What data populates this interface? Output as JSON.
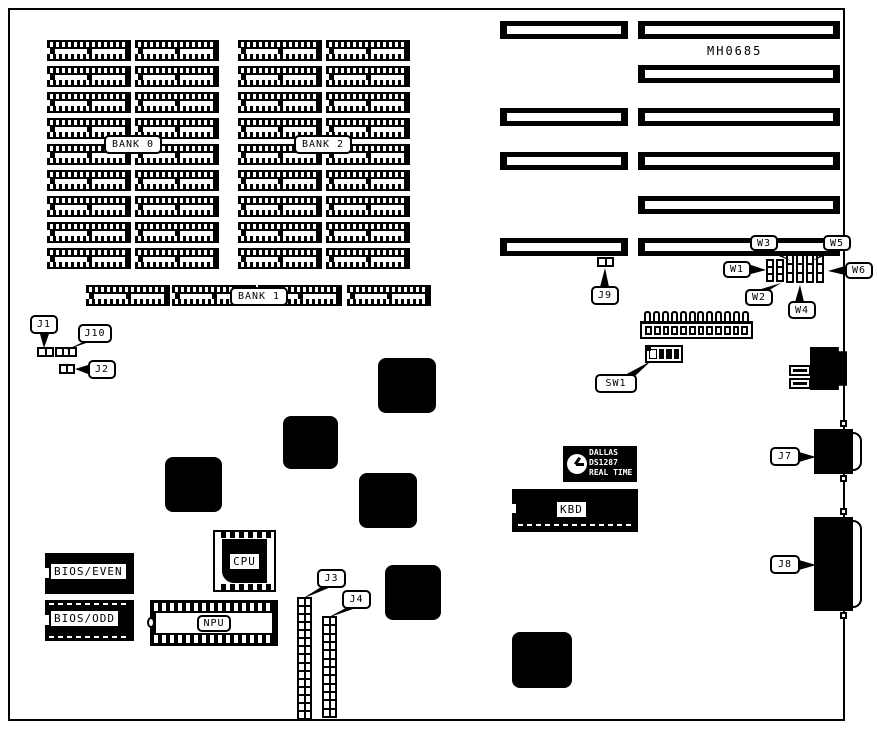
{
  "board": {
    "part_number": "MH0685"
  },
  "memory": {
    "bank0_label": "BANK 0",
    "bank1_label": "BANK 1",
    "bank2_label": "BANK 2",
    "bank_rows": 9,
    "bank_columns": 4,
    "bank1_sockets": 4
  },
  "expansion": {
    "short_slots": 4,
    "long_slots": 6
  },
  "power_connector": {
    "pins": 12
  },
  "switches": {
    "sw1_positions": 4,
    "sw1_pattern": [
      "open",
      "closed",
      "closed",
      "closed"
    ]
  },
  "jumper_blocks": {
    "w_count": 6
  },
  "chips": {
    "cpu_label": "CPU",
    "npu_label": "NPU",
    "kbd_label": "KBD",
    "bios_even_label": "BIOS/EVEN",
    "bios_odd_label": "BIOS/ODD",
    "dallas_line1": "DALLAS",
    "dallas_line2": "DS1287",
    "dallas_line3": "REAL TIME"
  },
  "callouts": {
    "j1": "J1",
    "j2": "J2",
    "j3": "J3",
    "j4": "J4",
    "j7": "J7",
    "j8": "J8",
    "j9": "J9",
    "j10": "J10",
    "w1": "W1",
    "w2": "W2",
    "w3": "W3",
    "w4": "W4",
    "w5": "W5",
    "w6": "W6",
    "sw1": "SW1"
  }
}
